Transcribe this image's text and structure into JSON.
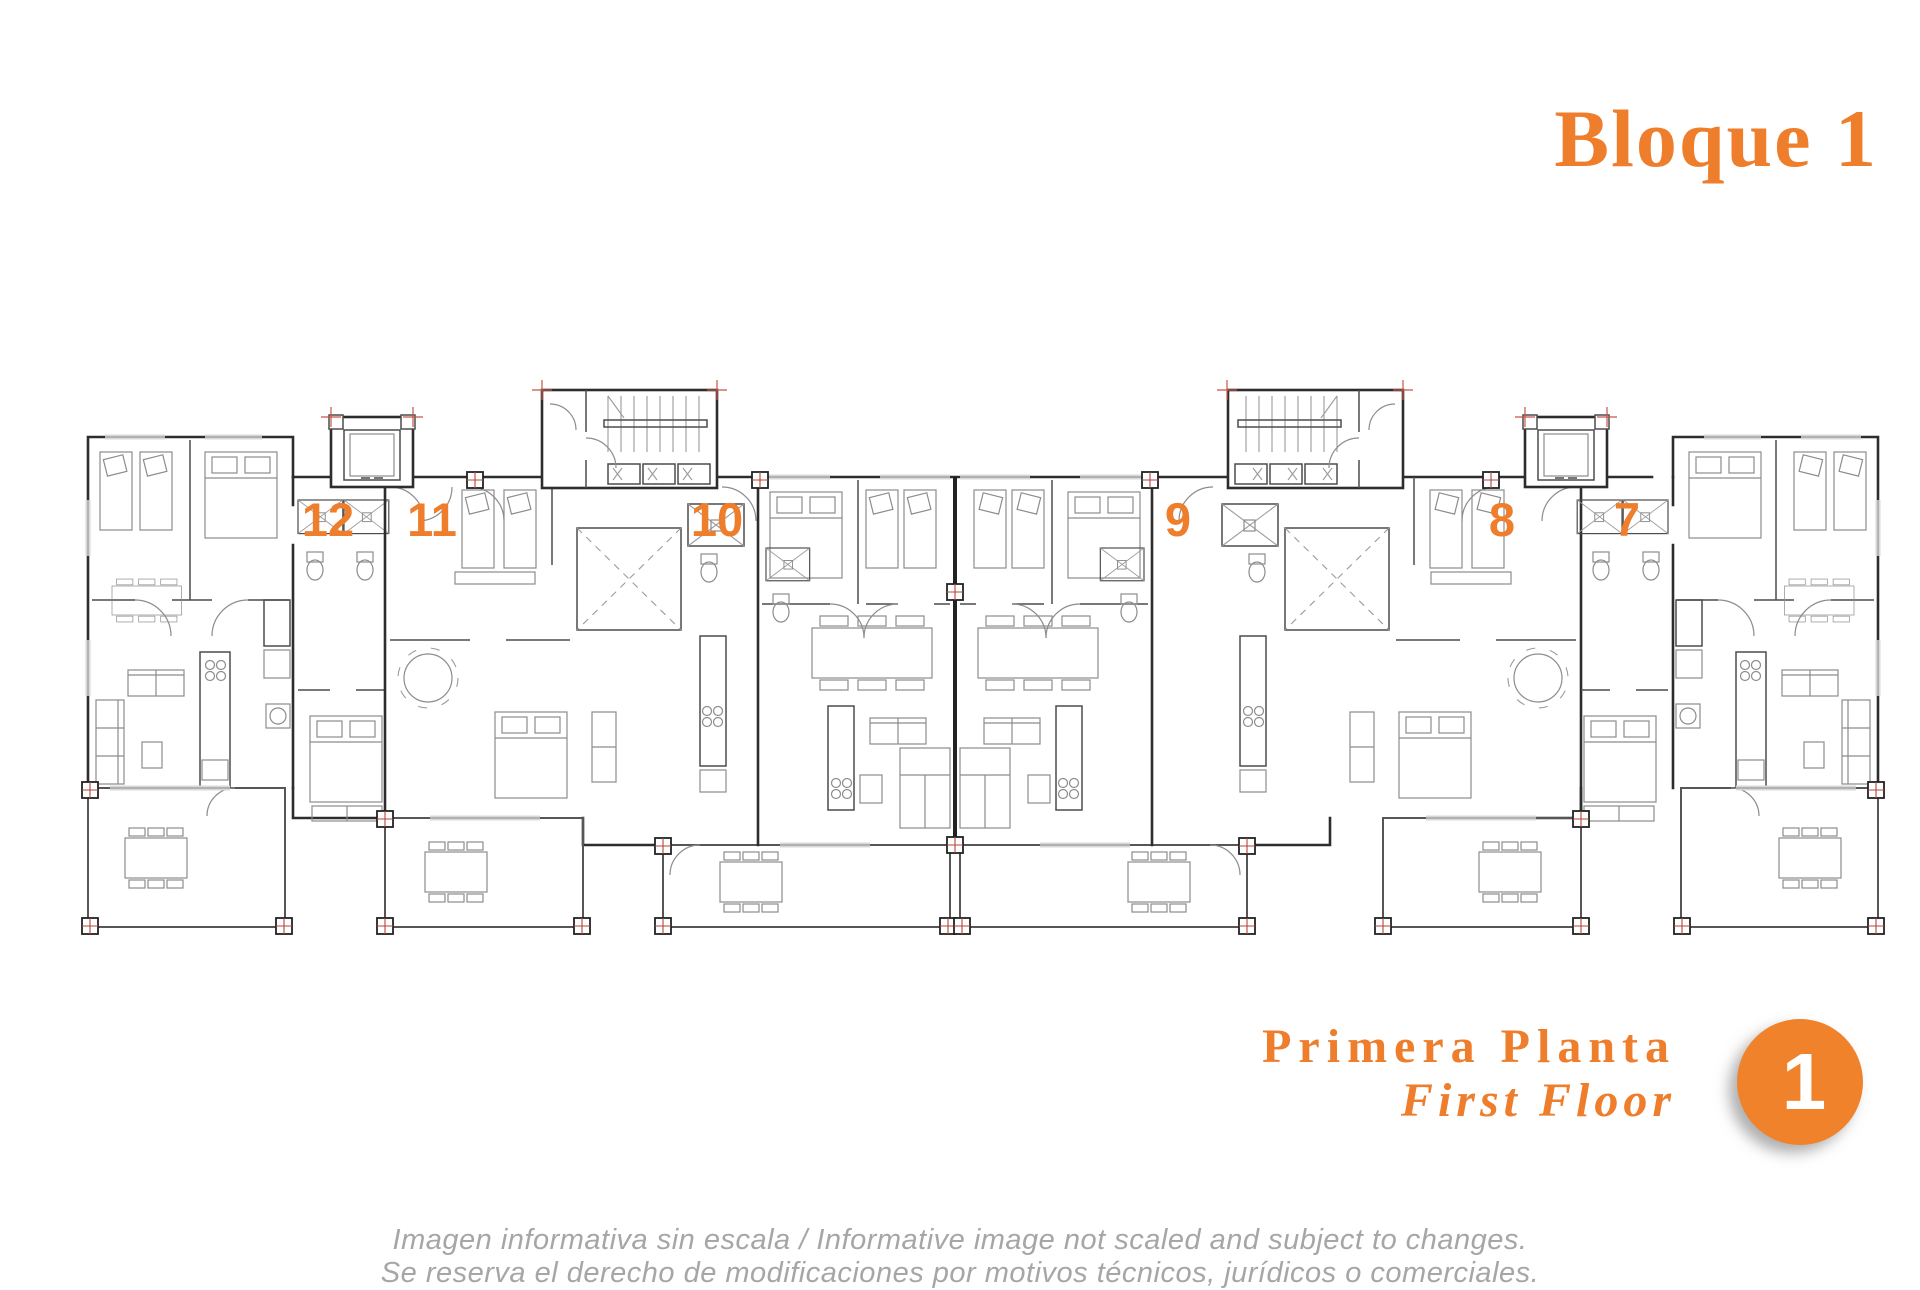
{
  "header": {
    "title": "Bloque 1"
  },
  "plan": {
    "units": [
      {
        "label": "12",
        "x": 328,
        "y": 536
      },
      {
        "label": "11",
        "x": 432,
        "y": 536
      },
      {
        "label": "10",
        "x": 717,
        "y": 536
      },
      {
        "label": "9",
        "x": 1178,
        "y": 536
      },
      {
        "label": "8",
        "x": 1502,
        "y": 536
      },
      {
        "label": "7",
        "x": 1627,
        "y": 536
      }
    ]
  },
  "floor_label": {
    "primary": "Primera Planta",
    "secondary": "First Floor"
  },
  "badge": {
    "number": "1"
  },
  "disclaimer": {
    "line1": "Imagen informativa sin escala /  Informative image not scaled and subject to changes.",
    "line2": "Se reserva el derecho de modificaciones por motivos técnicos, jurídicos o comerciales."
  },
  "colors": {
    "accent": "#EE7D2C",
    "badge_fill": "#F0822C",
    "wall": "#2d2d2d",
    "pillar_red": "#b5443a",
    "disclaimer_gray": "#a6a6a6"
  }
}
